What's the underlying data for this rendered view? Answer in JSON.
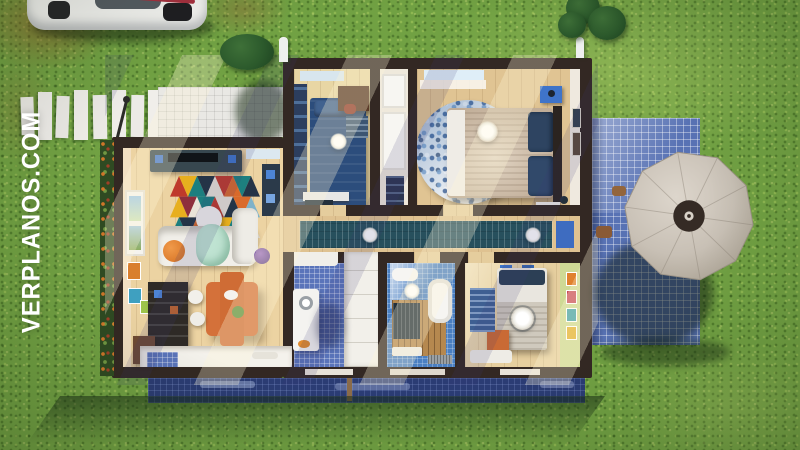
{
  "watermark": {
    "text": "VERPLANOS.COM",
    "color": "#ffffff",
    "orientation": "vertical-bottom-to-top"
  },
  "scene": {
    "type": "3d-floorplan-render",
    "view": "top-down",
    "setting": "single-storey house on a green lawn"
  },
  "exterior": {
    "car": {
      "label": "white car",
      "position": "top-left"
    },
    "stepping_stones": {
      "count": 8,
      "color": "#eceae6"
    },
    "front_drive": {
      "label": "white tiled drive",
      "position": "north-west of house"
    },
    "garden_lamp": {
      "label": "garden path light"
    },
    "side_patio": {
      "label": "blue tiled patio",
      "position": "east"
    },
    "terrace_strip": {
      "label": "blue tiled terrace",
      "position": "south"
    },
    "umbrella": {
      "label": "garden parasol",
      "canopy_color": "#c8c0b5",
      "cap_color": "#352b25"
    },
    "bushes": {
      "count": 4
    },
    "flower_planter": {
      "label": "flower bed along west wall",
      "flower_color": "#e07a2a"
    },
    "vent_pipes": {
      "count": 2
    }
  },
  "house": {
    "wall_color": "#332823",
    "floor_color": "#e4c795",
    "rooms": [
      {
        "id": "living-room",
        "label": "Living room",
        "furniture": [
          "tv-console",
          "triangle-rug",
          "sofa",
          "coffee-table",
          "orange-pouf",
          "west-window"
        ]
      },
      {
        "id": "dining-area",
        "label": "Dining area",
        "furniture": [
          "orange-dining-table",
          "chairs",
          "bookshelf",
          "wall-art",
          "south-counter"
        ]
      },
      {
        "id": "kitchen",
        "label": "Kitchen",
        "furniture": [
          "fridge",
          "tall-cabinets",
          "blue-tile-floor",
          "counter"
        ]
      },
      {
        "id": "hallway",
        "label": "Hallway",
        "furniture": [
          "striped-runner",
          "ceiling-lights",
          "blue-door-mat"
        ]
      },
      {
        "id": "entry-corridor",
        "label": "Entry corridor",
        "furniture": [
          "white-doors",
          "navy-dresser"
        ]
      },
      {
        "id": "bedroom-1",
        "label": "Bedroom 1",
        "furniture": [
          "navy-single-bed",
          "desk",
          "wardrobe",
          "ceiling-light",
          "bench"
        ]
      },
      {
        "id": "master-bedroom",
        "label": "Master bedroom",
        "furniture": [
          "double-bed",
          "round-blue-rug",
          "nightstands",
          "wall-frames",
          "ceiling-fan",
          "north-window"
        ]
      },
      {
        "id": "bathroom",
        "label": "Bathroom",
        "furniture": [
          "bathtub",
          "sink",
          "radiator",
          "wood-deck-floor",
          "ceiling-light",
          "drain-grate"
        ]
      },
      {
        "id": "bedroom-2",
        "label": "Bedroom 2",
        "furniture": [
          "double-bed",
          "striped-rug",
          "orange-dresser",
          "wall-art",
          "ceiling-fan",
          "white-mat"
        ]
      }
    ]
  },
  "palette": {
    "grass": "#71a143",
    "grass_shadow": "#3e6a2a",
    "wall": "#332823",
    "wood_floor": "#e4c795",
    "patio_tile_blue": "#5872b4",
    "terrace_blue": "#2b3c74",
    "white_tile": "#e9e8e4",
    "umbrella": "#c8c0b5",
    "accent_orange": "#d4713a",
    "navy_bedding": "#2c4d7c",
    "teal_runner": "#27505d"
  }
}
